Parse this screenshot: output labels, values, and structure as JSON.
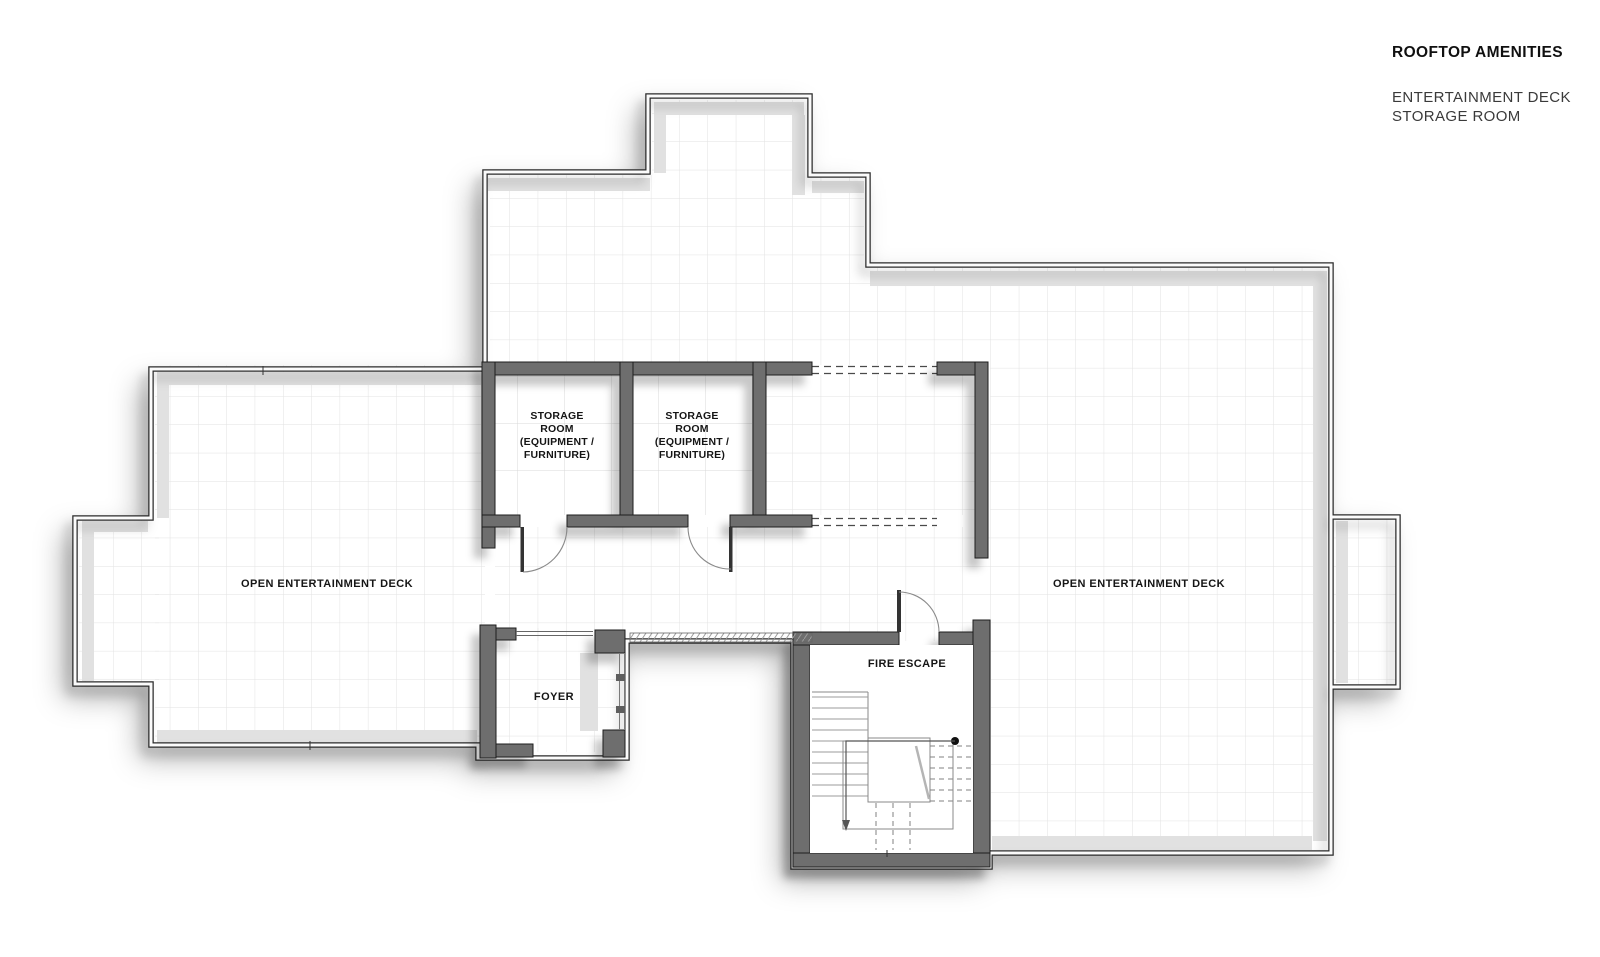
{
  "title_block": {
    "title": "ROOFTOP AMENITIES",
    "subtitle_line1": "ENTERTAINMENT DECK",
    "subtitle_line2": "STORAGE ROOM"
  },
  "plan": {
    "labels": {
      "left_deck": "OPEN ENTERTAINMENT DECK",
      "right_deck": "OPEN ENTERTAINMENT DECK",
      "storage_room_1": [
        "STORAGE",
        "ROOM",
        "(EQUIPMENT /",
        "FURNITURE)"
      ],
      "storage_room_2": [
        "STORAGE",
        "ROOM",
        "(EQUIPMENT /",
        "FURNITURE)"
      ],
      "foyer": "FOYER",
      "fire_escape": "FIRE ESCAPE"
    },
    "colors": {
      "wall": "#6e6e6e",
      "wall_edge": "#1d1d1d",
      "grid_small": "#e2e2e2",
      "grid_large": "#d9d9d9",
      "text": "#151515",
      "background": "#ffffff"
    }
  }
}
